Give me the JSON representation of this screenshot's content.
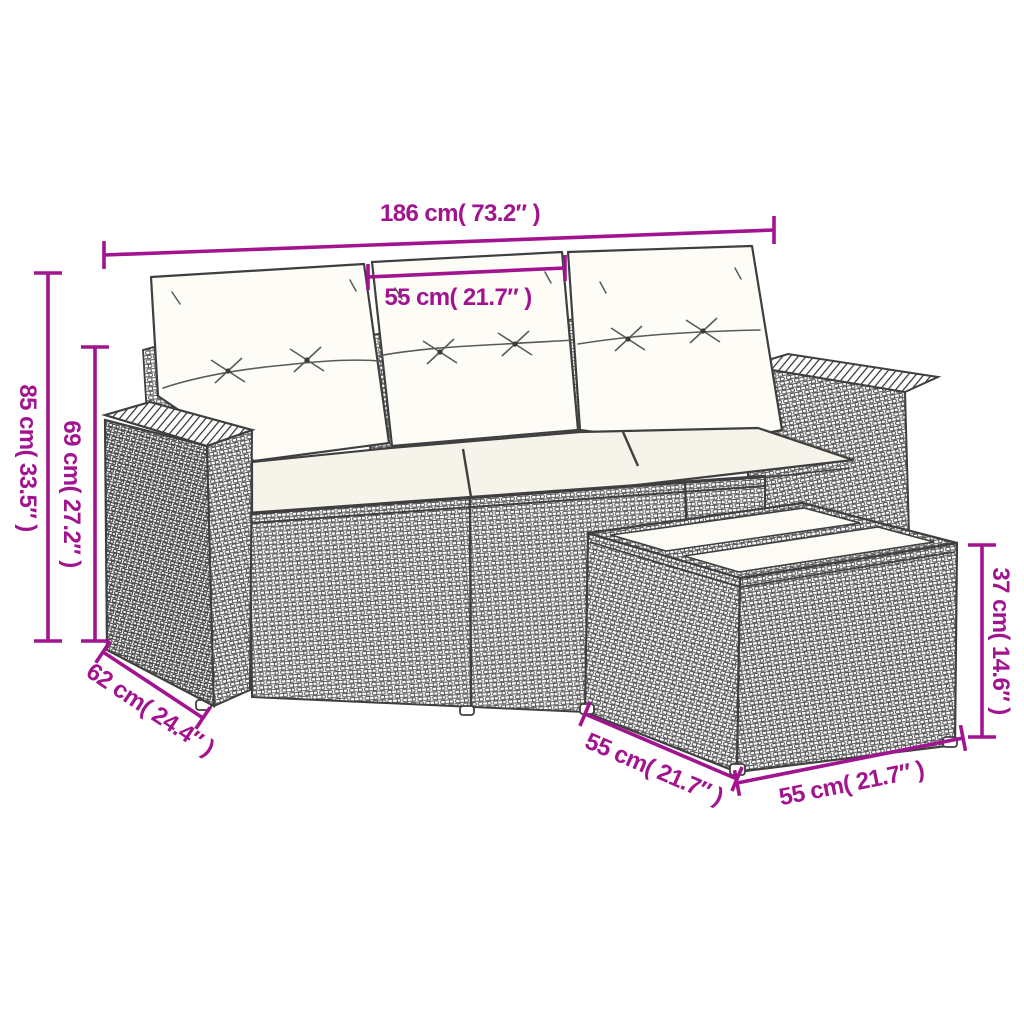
{
  "page": {
    "background_color": "#ffffff"
  },
  "diagram": {
    "subject": "rattan garden sofa set: 3-seater sofa with cushions and glass-top side table",
    "style": {
      "dimension_color": "#A2148F",
      "line_art_color": "#3f3f3f"
    },
    "dimensions": {
      "sofa_width": {
        "cm": "186",
        "inch": "73.2",
        "label": "186 cm( 73.2″ )"
      },
      "seat_width": {
        "cm": "55",
        "inch": "21.7",
        "label": "55 cm( 21.7″ )"
      },
      "sofa_height": {
        "cm": "85",
        "inch": "33.5",
        "label": "85 cm( 33.5″ )"
      },
      "back_height": {
        "cm": "69",
        "inch": "27.2",
        "label": "69 cm( 27.2″ )"
      },
      "sofa_depth": {
        "cm": "62",
        "inch": "24.4",
        "label": "62 cm( 24.4″ )"
      },
      "table_depth": {
        "cm": "55",
        "inch": "21.7",
        "label": "55 cm( 21.7″ )"
      },
      "table_width": {
        "cm": "55",
        "inch": "21.7",
        "label": "55 cm( 21.7″ )"
      },
      "table_height": {
        "cm": "37",
        "inch": "14.6",
        "label": "37 cm( 14.6″ )"
      }
    }
  }
}
